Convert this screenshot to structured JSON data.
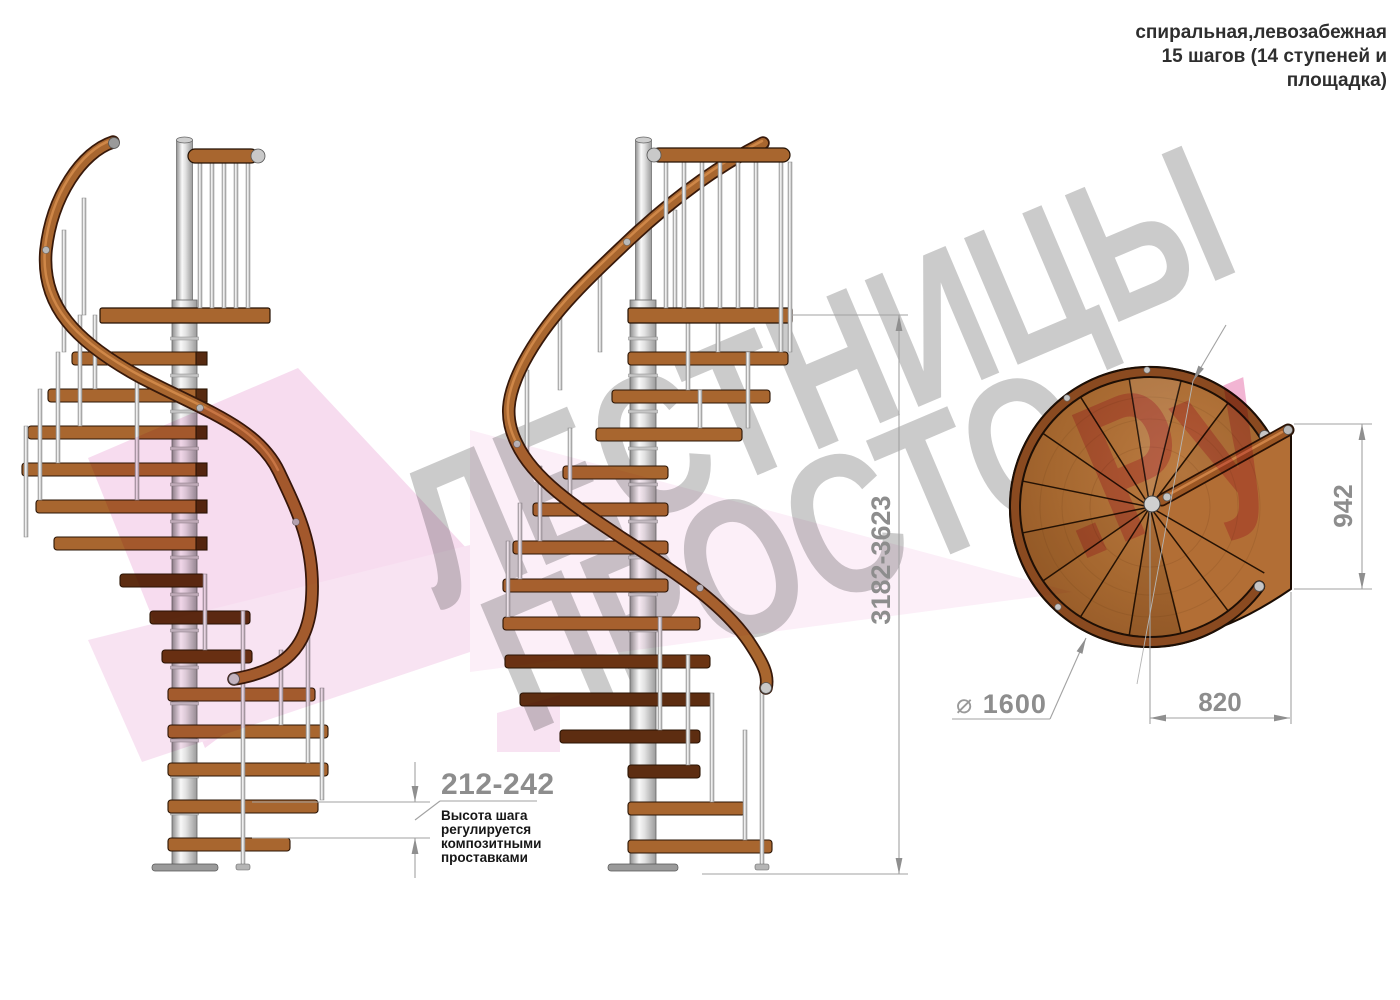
{
  "header": {
    "lines": [
      "спиральная,левозабежная",
      "15 шагов (14 ступеней и",
      "площадка)"
    ]
  },
  "watermark": {
    "line1": "ЛЕСТНИЦЫ",
    "line2": "ПРОСТО",
    "suffix": ".Ру",
    "gray": "#cbcbcb",
    "pink": "#ee9cc5"
  },
  "annotations": {
    "step_height": {
      "value": "212-242",
      "note_lines": [
        "Высота шага",
        "регулируется",
        "композитными",
        "проставками"
      ]
    },
    "total_height": {
      "value": "3182-3623"
    },
    "landing_width": {
      "value": "942"
    },
    "landing_depth": {
      "value": "820"
    },
    "diameter": {
      "symbol": "⌀",
      "value": "1600"
    }
  },
  "colors": {
    "wood": "#a8662f",
    "wood_dark": "#5d2d11",
    "metal": "#d9d9d9",
    "dimension_line": "#a2a2a2",
    "pink_ribbon": "#f0bfe2"
  }
}
